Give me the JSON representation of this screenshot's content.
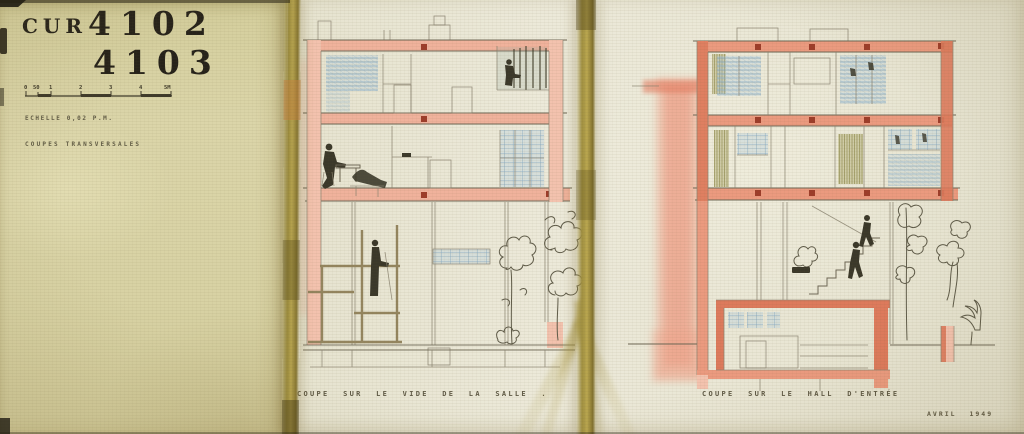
{
  "artwork": {
    "archive_code": "CUR",
    "drawing_numbers": [
      "4102",
      "4103"
    ],
    "scale_note": "ECHELLE 0,02 P.M.",
    "series_title": "COUPES TRANSVERSALES",
    "scale_bar_labels": [
      "0",
      "50",
      "1",
      "2",
      "3",
      "4",
      "5M"
    ],
    "captions": {
      "left_section": "COUPE SUR LE VIDE DE LA SALLE .",
      "right_section": "COUPE SUR LE HALL D'ENTRÉE"
    },
    "date": "AVRIL 1949",
    "colors": {
      "paper_left": "#d8d2a4",
      "paper_right": "#e9e6d4",
      "tape_olive": "#a6954a",
      "crayon_pink": "#f0b29c",
      "crayon_red": "#dd7a5c",
      "joint_red": "#9d3d2a",
      "crayon_blue": "#7ca3c2",
      "crayon_olive": "#97914f",
      "pencil_gray": "#6f6856",
      "ink_dark": "#3b382a"
    }
  }
}
